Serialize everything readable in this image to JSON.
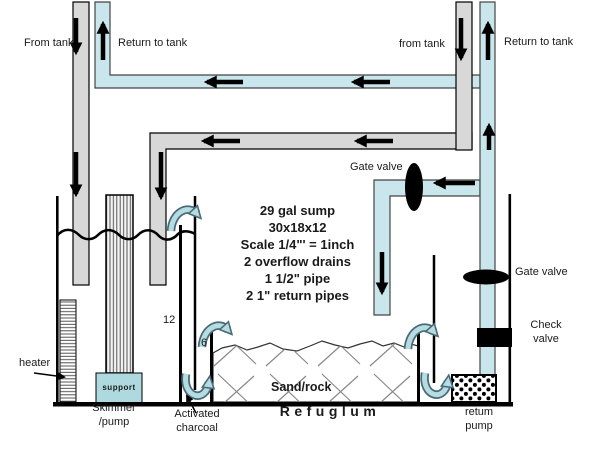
{
  "diagram": {
    "title_block": {
      "lines": [
        "29 gal sump",
        "30x18x12",
        "Scale 1/4\"' = 1inch",
        "2 overflow drains",
        "1 1/2\" pipe",
        "2 1\" return pipes"
      ]
    },
    "labels": {
      "from_tank_left": "From tank",
      "return_to_tank_left": "Return to tank",
      "from_tank_right": "from tank",
      "return_to_tank_right": "Return to tank",
      "gate_valve_upper": "Gate valve",
      "gate_valve_lower": "Gate valve",
      "check_valve_line1": "Check",
      "check_valve_line2": "valve",
      "heater": "heater",
      "support": "support",
      "skimmer_line1": "Skimmer",
      "skimmer_line2": "/pump",
      "charcoal_line1": "Activated",
      "charcoal_line2": "charcoal",
      "sand_rock": "Sand/rock",
      "refugium": "Refuglum",
      "return_pump_line1": "retum",
      "return_pump_line2": "pump",
      "baffle_height_12": "12",
      "baffle_height_6": "6"
    },
    "colors": {
      "pipe_gray": "#d8d8d8",
      "pipe_blue": "#c9e6ec",
      "flow_arrow_fill": "#b5dce3",
      "flow_arrow_outline": "#4a6b75",
      "valve_black": "#000000",
      "support_fill": "#aed9df"
    }
  }
}
